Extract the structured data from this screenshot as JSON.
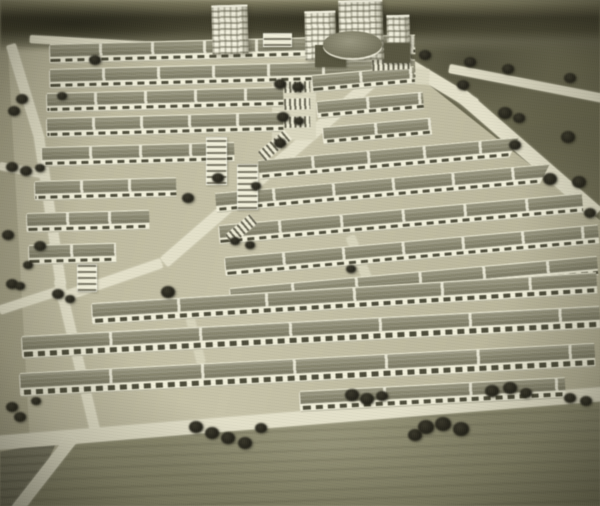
{
  "meta": {
    "kind": "black-and-white sepia photograph of an architectural scale model",
    "subject": "housing-estate master plan: parallel rows of slab apartment blocks, high-rise centre with round hall, perimeter roads, model trees and surrounding fields"
  },
  "palette": {
    "ground": "#b3af92",
    "estate": "#c0bc9f",
    "road": "#e3e0c7",
    "roof": "#86846b",
    "facade": "#f1efd8",
    "window": "#4d4c38",
    "dark_field": "#6a684e",
    "horizon": "#413f2c",
    "tree": "#232215",
    "tower": "#f4f2de"
  },
  "scene": {
    "roads": [
      {
        "x": 30,
        "y": 35,
        "w": 365,
        "h": 8,
        "a": 3.2,
        "cls": ""
      },
      {
        "x": 383,
        "y": 42,
        "w": 112,
        "h": 13,
        "a": 31,
        "cls": ""
      },
      {
        "x": 466,
        "y": 90,
        "w": 180,
        "h": 14,
        "a": 41,
        "cls": ""
      },
      {
        "x": 450,
        "y": 64,
        "w": 156,
        "h": 9,
        "a": 11,
        "cls": ""
      },
      {
        "x": 160,
        "y": 258,
        "w": 304,
        "h": 12,
        "a": -41,
        "cls": ""
      },
      {
        "x": 56,
        "y": 294,
        "w": 110,
        "h": 10,
        "a": -19,
        "cls": ""
      },
      {
        "x": 6,
        "y": 46,
        "w": 10,
        "h": 100,
        "a": -17,
        "cls": ""
      },
      {
        "x": 34,
        "y": 138,
        "w": 10,
        "h": 150,
        "a": -8.5,
        "cls": ""
      },
      {
        "x": 54,
        "y": 281,
        "w": 10,
        "h": 155,
        "a": -13.5,
        "cls": ""
      },
      {
        "x": 0,
        "y": 162,
        "w": 44,
        "h": 8,
        "a": 11,
        "cls": ""
      },
      {
        "x": -2,
        "y": 306,
        "w": 62,
        "h": 9,
        "a": -18,
        "cls": ""
      },
      {
        "x": -5,
        "y": 436,
        "w": 615,
        "h": 14,
        "a": -4.6,
        "cls": ""
      },
      {
        "x": 68,
        "y": 434,
        "w": 12,
        "h": 92,
        "a": 38,
        "cls": ""
      },
      {
        "x": 346,
        "y": 238,
        "w": 9,
        "h": 68,
        "a": -22,
        "cls": "minor"
      },
      {
        "x": 186,
        "y": 318,
        "w": 8,
        "h": 48,
        "a": -14,
        "cls": "minor"
      },
      {
        "x": 272,
        "y": 76,
        "w": 44,
        "h": 64,
        "a": 0,
        "cls": "lot"
      },
      {
        "x": 300,
        "y": 46,
        "w": 102,
        "h": 12,
        "a": 3,
        "cls": "lot"
      },
      {
        "x": 302,
        "y": 62,
        "w": 128,
        "h": 16,
        "a": 3,
        "cls": "lot"
      }
    ],
    "slab_rows": [
      {
        "x": 50,
        "y": 44,
        "w": 365,
        "a": -1.5,
        "roof": 12,
        "face": 6,
        "seg": 52
      },
      {
        "x": 50,
        "y": 69,
        "w": 365,
        "a": -1.5,
        "roof": 12,
        "face": 6,
        "seg": 55
      },
      {
        "x": 47,
        "y": 93,
        "w": 236,
        "a": -1.5,
        "roof": 12,
        "face": 6,
        "seg": 50
      },
      {
        "x": 47,
        "y": 118,
        "w": 236,
        "a": -1.5,
        "roof": 12,
        "face": 6,
        "seg": 48
      },
      {
        "x": 42,
        "y": 147,
        "w": 192,
        "a": -1.5,
        "roof": 12,
        "face": 6,
        "seg": 50
      },
      {
        "x": 35,
        "y": 181,
        "w": 141,
        "a": -1.5,
        "roof": 12,
        "face": 6,
        "seg": 48
      },
      {
        "x": 27,
        "y": 213,
        "w": 122,
        "a": -1.5,
        "roof": 12,
        "face": 6,
        "seg": 42
      },
      {
        "x": 29,
        "y": 245,
        "w": 87,
        "a": -1.5,
        "roof": 12,
        "face": 6,
        "seg": 44
      },
      {
        "x": 312,
        "y": 75,
        "w": 102,
        "a": -5,
        "roof": 11,
        "face": 5,
        "seg": 50
      },
      {
        "x": 317,
        "y": 101,
        "w": 106,
        "a": -5,
        "roof": 11,
        "face": 5,
        "seg": 52
      },
      {
        "x": 323,
        "y": 127,
        "w": 108,
        "a": -5,
        "roof": 11,
        "face": 5,
        "seg": 54
      },
      {
        "x": 258,
        "y": 160,
        "w": 262,
        "a": -5,
        "roof": 12,
        "face": 6,
        "seg": 56,
        "cut": 1
      },
      {
        "x": 215,
        "y": 193,
        "w": 336,
        "a": -5,
        "roof": 12,
        "face": 6,
        "seg": 60,
        "cut": 1
      },
      {
        "x": 219,
        "y": 225,
        "w": 364,
        "a": -5,
        "roof": 12,
        "face": 6,
        "seg": 62
      },
      {
        "x": 225,
        "y": 257,
        "w": 374,
        "a": -5,
        "roof": 12,
        "face": 6,
        "seg": 60
      },
      {
        "x": 230,
        "y": 288,
        "w": 368,
        "a": -5,
        "roof": 12,
        "face": 6,
        "seg": 64
      },
      {
        "x": 92,
        "y": 303,
        "w": 505,
        "a": -3.5,
        "roof": 13,
        "face": 7,
        "seg": 88
      },
      {
        "x": 22,
        "y": 336,
        "w": 578,
        "a": -3,
        "roof": 13,
        "face": 8,
        "seg": 90
      },
      {
        "x": 20,
        "y": 373,
        "w": 575,
        "a": -3,
        "roof": 14,
        "face": 8,
        "seg": 92
      },
      {
        "x": 300,
        "y": 391,
        "w": 265,
        "a": -3,
        "roof": 12,
        "face": 7,
        "seg": 86
      }
    ],
    "small_blocks": [
      {
        "x": 206,
        "y": 137,
        "w": 19,
        "h": 46
      },
      {
        "x": 237,
        "y": 164,
        "w": 19,
        "h": 44
      },
      {
        "x": 77,
        "y": 264,
        "w": 18,
        "h": 26
      },
      {
        "x": 263,
        "y": 33,
        "w": 27,
        "h": 12
      }
    ],
    "pads": [
      {
        "x": 284,
        "y": 82,
        "w": 26,
        "h": 11,
        "a": -2
      },
      {
        "x": 284,
        "y": 99,
        "w": 26,
        "h": 11,
        "a": -2
      },
      {
        "x": 284,
        "y": 117,
        "w": 26,
        "h": 11,
        "a": -2
      },
      {
        "x": 258,
        "y": 152,
        "w": 34,
        "h": 12,
        "a": -40
      },
      {
        "x": 225,
        "y": 235,
        "w": 32,
        "h": 12,
        "a": -40
      },
      {
        "x": 372,
        "y": 60,
        "w": 38,
        "h": 11,
        "a": -3
      }
    ],
    "towers": [
      {
        "x": 212,
        "y": 5,
        "w": 36,
        "h": 47
      },
      {
        "x": 305,
        "y": 11,
        "w": 31,
        "h": 47
      },
      {
        "x": 339,
        "y": 0,
        "w": 44,
        "h": 58
      },
      {
        "x": 387,
        "y": 15,
        "w": 23,
        "h": 45
      }
    ],
    "hall": {
      "x": 323,
      "y": 31,
      "w": 59,
      "h": 27
    },
    "podiums": [
      {
        "x": 315,
        "y": 45,
        "w": 31,
        "h": 22
      },
      {
        "x": 384,
        "y": 43,
        "w": 26,
        "h": 20
      }
    ],
    "trees": [
      {
        "x": 95,
        "y": 60,
        "r": 6
      },
      {
        "x": 62,
        "y": 96,
        "r": 5
      },
      {
        "x": 22,
        "y": 99,
        "r": 6
      },
      {
        "x": 14,
        "y": 111,
        "r": 6
      },
      {
        "x": 12,
        "y": 167,
        "r": 6
      },
      {
        "x": 26,
        "y": 171,
        "r": 6
      },
      {
        "x": 40,
        "y": 168,
        "r": 5
      },
      {
        "x": 8,
        "y": 235,
        "r": 6
      },
      {
        "x": 40,
        "y": 246,
        "r": 6
      },
      {
        "x": 28,
        "y": 265,
        "r": 5
      },
      {
        "x": 12,
        "y": 284,
        "r": 6
      },
      {
        "x": 20,
        "y": 286,
        "r": 5
      },
      {
        "x": 58,
        "y": 294,
        "r": 6
      },
      {
        "x": 70,
        "y": 299,
        "r": 5
      },
      {
        "x": 168,
        "y": 292,
        "r": 7
      },
      {
        "x": 12,
        "y": 407,
        "r": 6
      },
      {
        "x": 20,
        "y": 417,
        "r": 6
      },
      {
        "x": 36,
        "y": 401,
        "r": 5
      },
      {
        "x": 196,
        "y": 427,
        "r": 7
      },
      {
        "x": 212,
        "y": 433,
        "r": 7
      },
      {
        "x": 228,
        "y": 438,
        "r": 7
      },
      {
        "x": 245,
        "y": 443,
        "r": 7
      },
      {
        "x": 261,
        "y": 428,
        "r": 6
      },
      {
        "x": 352,
        "y": 395,
        "r": 7
      },
      {
        "x": 367,
        "y": 399,
        "r": 7
      },
      {
        "x": 382,
        "y": 396,
        "r": 6
      },
      {
        "x": 415,
        "y": 435,
        "r": 7
      },
      {
        "x": 426,
        "y": 427,
        "r": 8
      },
      {
        "x": 443,
        "y": 424,
        "r": 8
      },
      {
        "x": 461,
        "y": 429,
        "r": 8
      },
      {
        "x": 492,
        "y": 391,
        "r": 7
      },
      {
        "x": 510,
        "y": 388,
        "r": 7
      },
      {
        "x": 526,
        "y": 393,
        "r": 6
      },
      {
        "x": 570,
        "y": 398,
        "r": 6
      },
      {
        "x": 586,
        "y": 401,
        "r": 6
      },
      {
        "x": 425,
        "y": 55,
        "r": 6
      },
      {
        "x": 470,
        "y": 62,
        "r": 6
      },
      {
        "x": 508,
        "y": 69,
        "r": 6
      },
      {
        "x": 570,
        "y": 78,
        "r": 6
      },
      {
        "x": 463,
        "y": 85,
        "r": 6
      },
      {
        "x": 505,
        "y": 113,
        "r": 7
      },
      {
        "x": 519,
        "y": 118,
        "r": 6
      },
      {
        "x": 515,
        "y": 145,
        "r": 6
      },
      {
        "x": 568,
        "y": 137,
        "r": 7
      },
      {
        "x": 550,
        "y": 179,
        "r": 7
      },
      {
        "x": 579,
        "y": 182,
        "r": 7
      },
      {
        "x": 590,
        "y": 213,
        "r": 6
      },
      {
        "x": 280,
        "y": 84,
        "r": 6
      },
      {
        "x": 298,
        "y": 87,
        "r": 6
      },
      {
        "x": 283,
        "y": 117,
        "r": 6
      },
      {
        "x": 299,
        "y": 121,
        "r": 5
      },
      {
        "x": 280,
        "y": 143,
        "r": 6
      },
      {
        "x": 256,
        "y": 186,
        "r": 5
      },
      {
        "x": 218,
        "y": 178,
        "r": 6
      },
      {
        "x": 188,
        "y": 198,
        "r": 6
      },
      {
        "x": 235,
        "y": 241,
        "r": 5
      },
      {
        "x": 250,
        "y": 245,
        "r": 5
      },
      {
        "x": 351,
        "y": 269,
        "r": 5
      }
    ]
  }
}
